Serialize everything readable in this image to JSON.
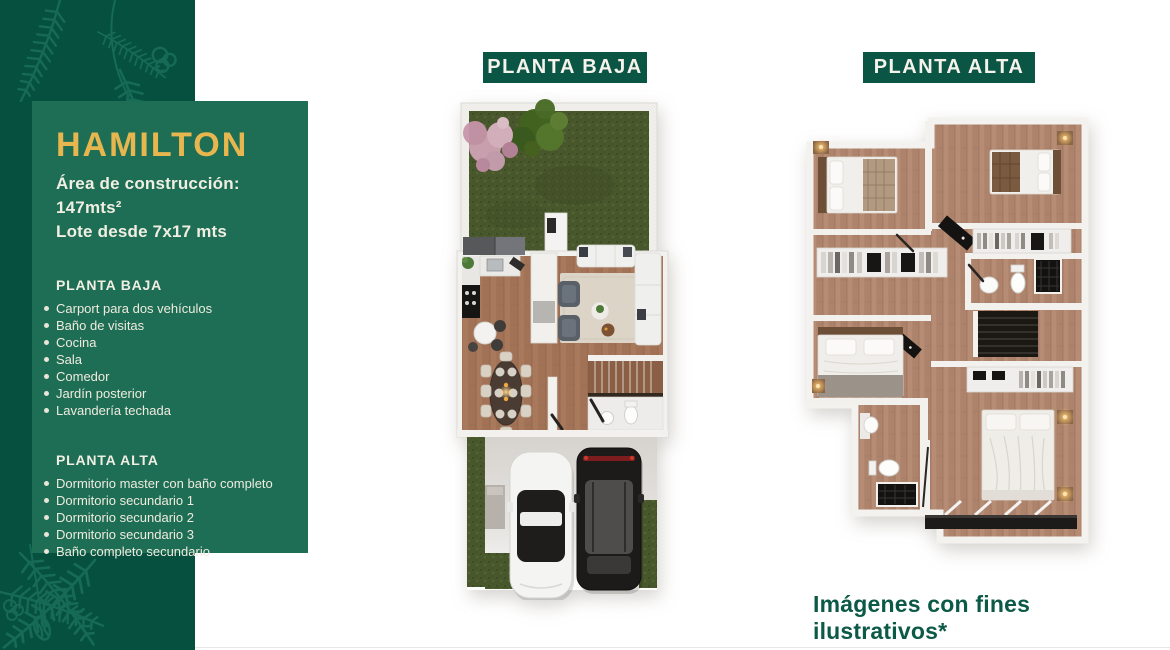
{
  "card": {
    "title": "HAMILTON",
    "area_line": "Área de construcción: 147mts²",
    "lot_line": "Lote desde 7x17 mts",
    "planta_baja": {
      "heading": "PLANTA BAJA",
      "items": [
        "Carport para dos vehículos",
        "Baño de visitas",
        "Cocina",
        "Sala",
        "Comedor",
        "Jardín posterior",
        "Lavandería techada"
      ]
    },
    "planta_alta": {
      "heading": "PLANTA ALTA",
      "items": [
        "Dormitorio master con baño completo",
        "Dormitorio secundario 1",
        "Dormitorio secundario 2",
        "Dormitorio secundario 3",
        "Baño completo secundario"
      ]
    }
  },
  "plans": {
    "baja": {
      "label": "PLANTA BAJA"
    },
    "alta": {
      "label": "PLANTA ALTA"
    }
  },
  "footer": {
    "disclaimer": "Imágenes con fines ilustrativos*"
  },
  "icons": {
    "sidebar_decoration": "fern-branch-outline",
    "plan_baja_image": "floorplan-ground-floor-illustration",
    "plan_alta_image": "floorplan-upper-floor-illustration"
  },
  "colors": {
    "sidebar_dark_green": "#05503F",
    "card_green": "#1E6E55",
    "accent_gold": "#E7B64F",
    "chip_green": "#0B5544",
    "text_cream": "#F1EEE3",
    "disclaimer_green": "#0B5946"
  }
}
